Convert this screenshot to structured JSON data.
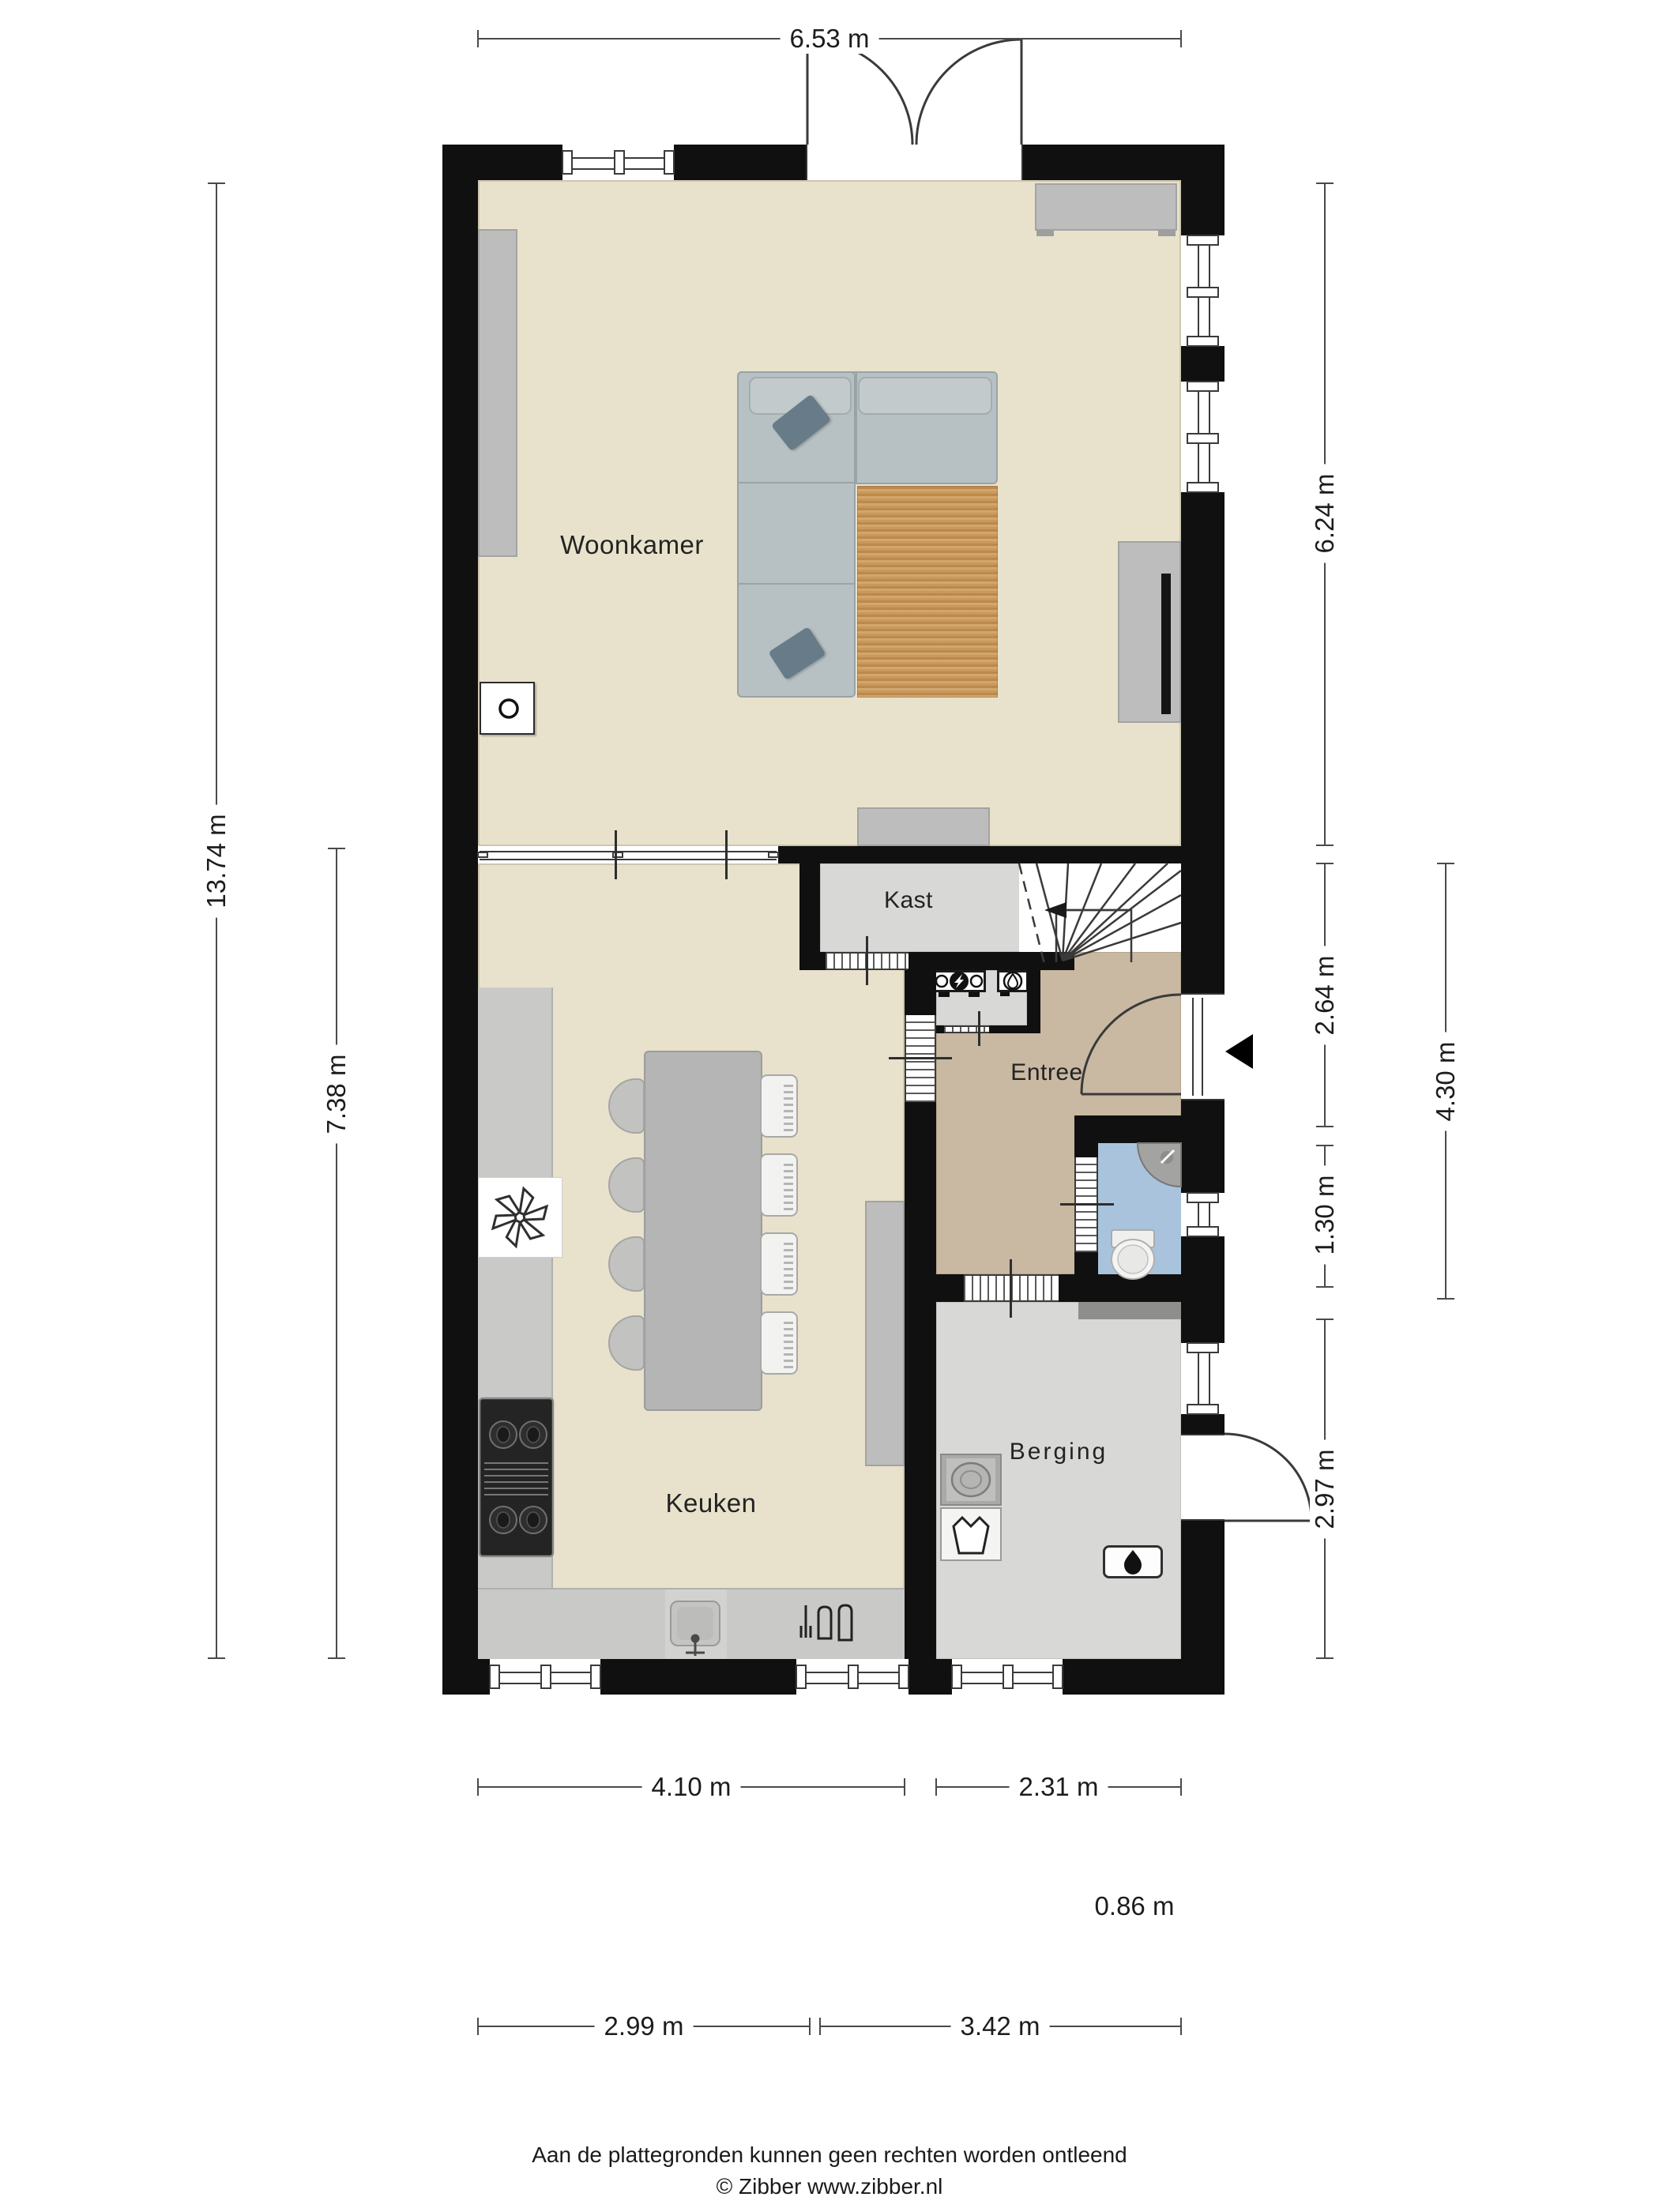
{
  "plan": {
    "type": "floorplan-ground-floor",
    "rooms": {
      "woonkamer": {
        "label": "Woonkamer"
      },
      "keuken": {
        "label": "Keuken"
      },
      "kast": {
        "label": "Kast"
      },
      "entree": {
        "label": "Entree"
      },
      "berging": {
        "label": "Berging"
      }
    },
    "dimensions": {
      "top_width": "6.53 m",
      "left_total": "13.74 m",
      "left_kitchen": "7.38 m",
      "right_livingroom": "6.24 m",
      "right_entree": "2.64 m",
      "right_toilet": "1.30 m",
      "right_berging": "2.97 m",
      "right_hall_total": "4.30 m",
      "bottom_kitchen": "4.10 m",
      "bottom_berging": "2.31 m",
      "bottom_small": "0.86 m",
      "bottom_left": "2.99 m",
      "bottom_right": "3.42 m"
    },
    "colors": {
      "wall": "#101010",
      "floor_living": "#e8e2cc",
      "floor_hall": "#c9b8a2",
      "floor_storage": "#d8d8d6",
      "floor_toilet": "#a9c3dc",
      "rug": "#c79250",
      "sofa": "#b7c0c3"
    },
    "footer": {
      "disclaimer": "Aan de plattegronden kunnen geen rechten worden ontleend",
      "credit": "© Zibber www.zibber.nl"
    }
  }
}
